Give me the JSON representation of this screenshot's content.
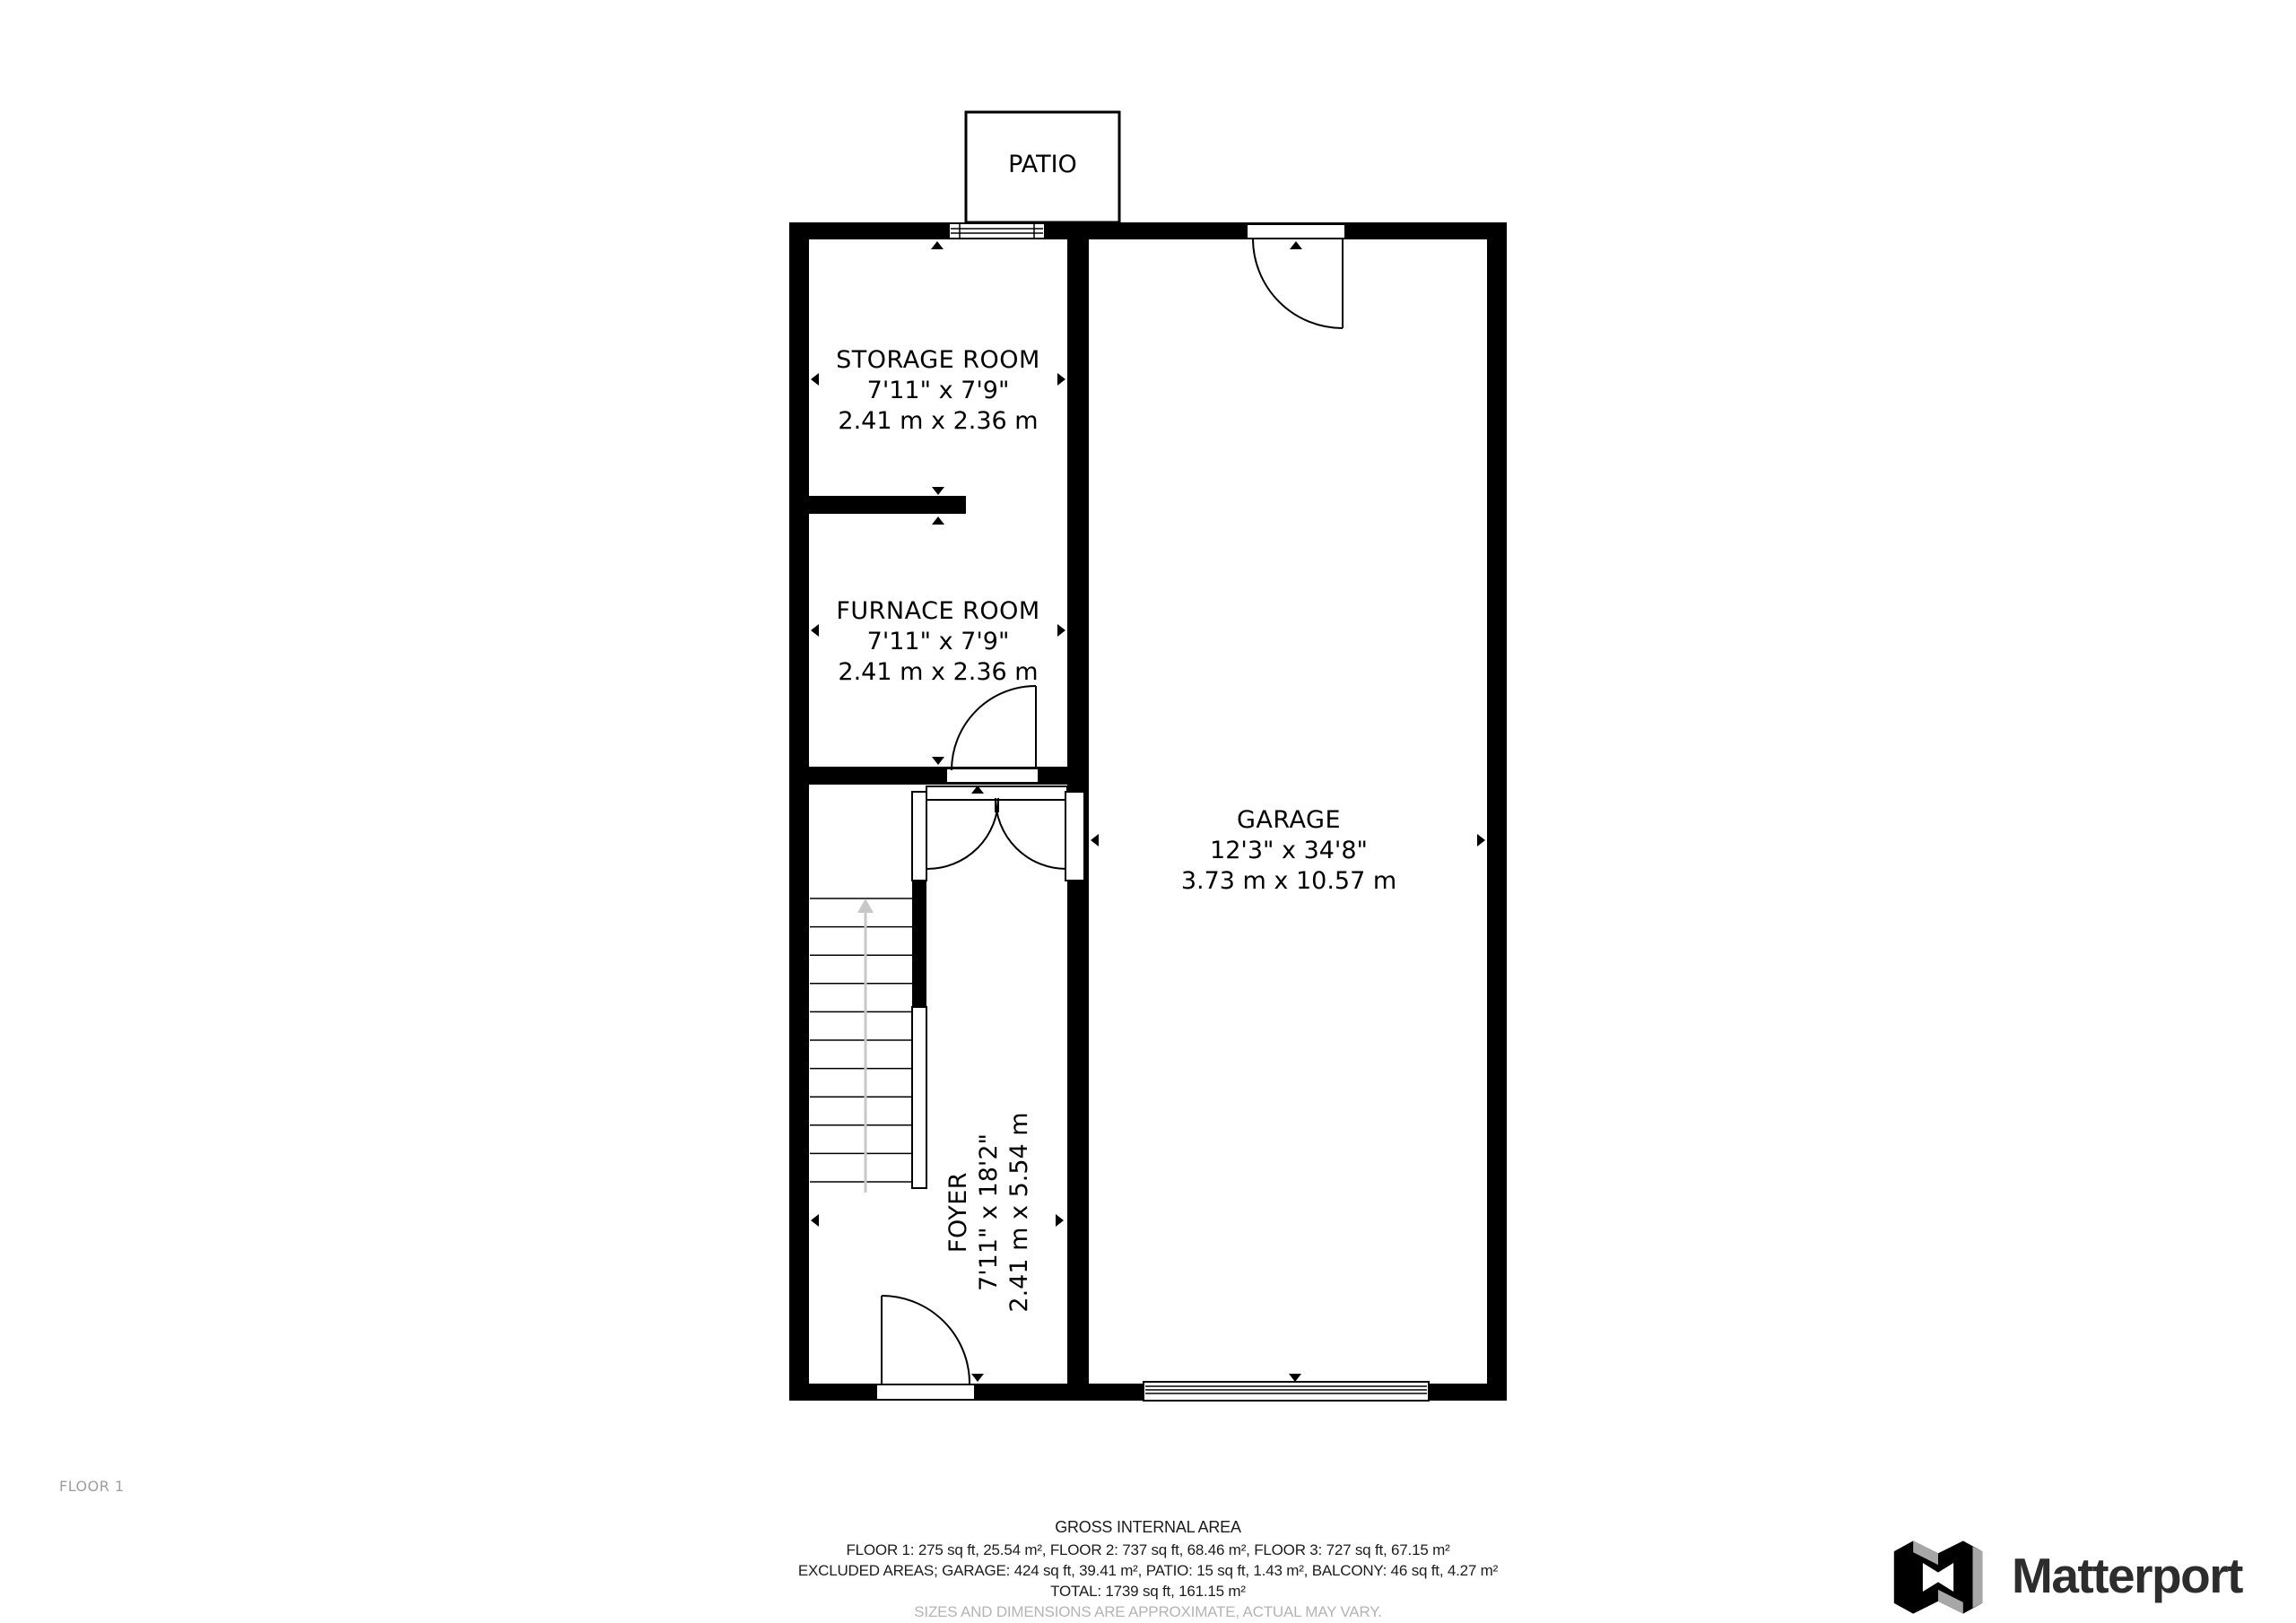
{
  "plan": {
    "floor_label": "FLOOR 1",
    "patio_label": "PATIO",
    "rooms": {
      "storage": {
        "name": "STORAGE ROOM",
        "dims_ft": "7'11\" x 7'9\"",
        "dims_m": "2.41 m x 2.36 m"
      },
      "furnace": {
        "name": "FURNACE ROOM",
        "dims_ft": "7'11\" x 7'9\"",
        "dims_m": "2.41 m x 2.36 m"
      },
      "garage": {
        "name": "GARAGE",
        "dims_ft": "12'3\" x 34'8\"",
        "dims_m": "3.73 m x 10.57 m"
      },
      "foyer": {
        "name": "FOYER",
        "dims_ft": "7'11\" x 18'2\"",
        "dims_m": "2.41 m x 5.54 m"
      }
    }
  },
  "footer": {
    "title": "GROSS INTERNAL AREA",
    "line1": "FLOOR 1: 275 sq ft, 25.54 m², FLOOR 2: 737 sq ft, 68.46 m², FLOOR 3: 727 sq ft, 67.15 m²",
    "line2": "EXCLUDED AREAS; GARAGE: 424 sq ft, 39.41 m², PATIO: 15 sq ft, 1.43 m², BALCONY: 46 sq ft, 4.27 m²",
    "line3": "TOTAL: 1739 sq ft, 161.15 m²",
    "disclaimer": "SIZES AND DIMENSIONS ARE APPROXIMATE, ACTUAL MAY VARY."
  },
  "brand": {
    "name": "Matterport"
  },
  "colors": {
    "wall": "#000000",
    "stair_arrow": "#c8c8c8",
    "disclaimer_gray": "#b4b4b4",
    "floor_label_gray": "#9e9e9e",
    "brand_text": "#2d2d2d",
    "brand_side_gray": "#a7a7a7"
  }
}
